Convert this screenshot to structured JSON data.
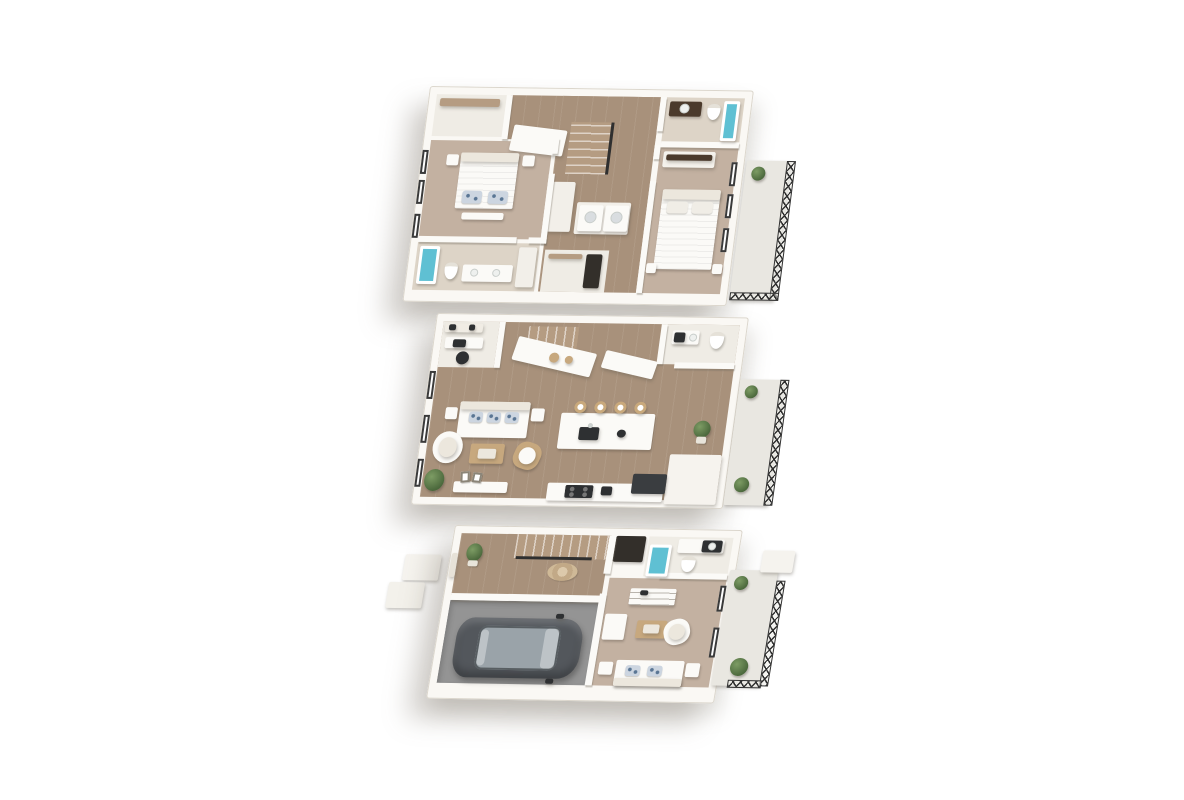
{
  "page": {
    "background": "#ffffff",
    "type": "3d-floor-plan-rendering",
    "floors_count": 3,
    "view": "stacked isometric floor plans, upper floor on top, ground floor at bottom"
  },
  "palette": {
    "wall": "#faf8f4",
    "wood": "#a8917b",
    "stair_wood": "#b59c82",
    "carpet": "#c3b1a1",
    "bath_tile": "#ddd4c7",
    "tile_white": "#efece5",
    "deck": "#e9e7e1",
    "garage": "#949494",
    "teal": "#5fc0d3",
    "white_furn": "#fbfaf7",
    "cream": "#ece7dd",
    "dark_wood": "#4b3a2c",
    "closet_dark": "#332f2a",
    "appliance": "#2e3032",
    "fridge": "#3a3d40",
    "car_body": "#53575c",
    "car_glass": "#9aa3a9",
    "rattan": "#c7a87e",
    "plant": "#5f7d4f",
    "railing": "#2f2f2f",
    "window": "#3a3a3a",
    "pillow": "#ccd5e0",
    "rug": "#cbb49a"
  },
  "floors": [
    {
      "id": "upper-floor",
      "position": "top",
      "rooms": [
        "bedroom-left",
        "bedroom-right",
        "bathroom-left",
        "bathroom-right",
        "laundry-closet",
        "linen-closet",
        "walk-in-closet",
        "hallway-stairs",
        "balcony"
      ]
    },
    {
      "id": "main-floor",
      "position": "middle",
      "rooms": [
        "living-room",
        "kitchen",
        "island-dining",
        "desk-nook",
        "powder-room",
        "stairs",
        "balcony"
      ]
    },
    {
      "id": "ground-floor",
      "position": "bottom",
      "rooms": [
        "entry-hall",
        "entry-steps",
        "garage",
        "bathroom",
        "den",
        "stairs",
        "patio"
      ]
    }
  ]
}
